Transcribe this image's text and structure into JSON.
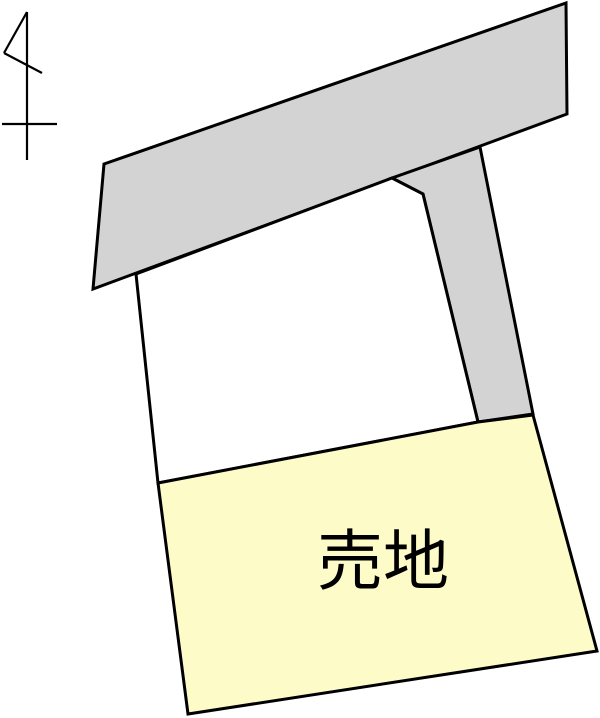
{
  "diagram": {
    "title": "land-plot-site-map",
    "background": "#ffffff"
  },
  "colors": {
    "road_fill": "#d3d3d3",
    "plot_fill": "#ffffff",
    "sale_fill": "#fdfbc8",
    "outline": "#000000"
  },
  "north_arrow": {
    "stroke_width": 2.2,
    "lines": [
      [
        27,
        12,
        27,
        160
      ],
      [
        27,
        12,
        4,
        53
      ],
      [
        4,
        53,
        42,
        73
      ],
      [
        2,
        124,
        57,
        124
      ]
    ]
  },
  "shapes": [
    {
      "name": "road-upper",
      "fill_key": "road_fill",
      "stroke_width": 3,
      "points": [
        [
          104,
          164
        ],
        [
          566,
          3
        ],
        [
          567,
          114
        ],
        [
          93,
          289
        ]
      ]
    },
    {
      "name": "road-side-strip",
      "fill_key": "road_fill",
      "stroke_width": 3,
      "points": [
        [
          392,
          178
        ],
        [
          423,
          194
        ],
        [
          478,
          422
        ],
        [
          533,
          414
        ],
        [
          480,
          147
        ]
      ]
    },
    {
      "name": "plot-middle",
      "fill_key": "plot_fill",
      "stroke_width": 3,
      "points": [
        [
          136,
          274
        ],
        [
          392,
          178
        ],
        [
          423,
          194
        ],
        [
          478,
          422
        ],
        [
          158,
          483
        ]
      ]
    },
    {
      "name": "plot-for-sale",
      "fill_key": "sale_fill",
      "stroke_width": 3,
      "points": [
        [
          158,
          483
        ],
        [
          478,
          422
        ],
        [
          533,
          415
        ],
        [
          597,
          651
        ],
        [
          188,
          714
        ]
      ]
    }
  ],
  "label": {
    "text": "売地",
    "x": 383,
    "y": 584,
    "font_size": 66
  }
}
